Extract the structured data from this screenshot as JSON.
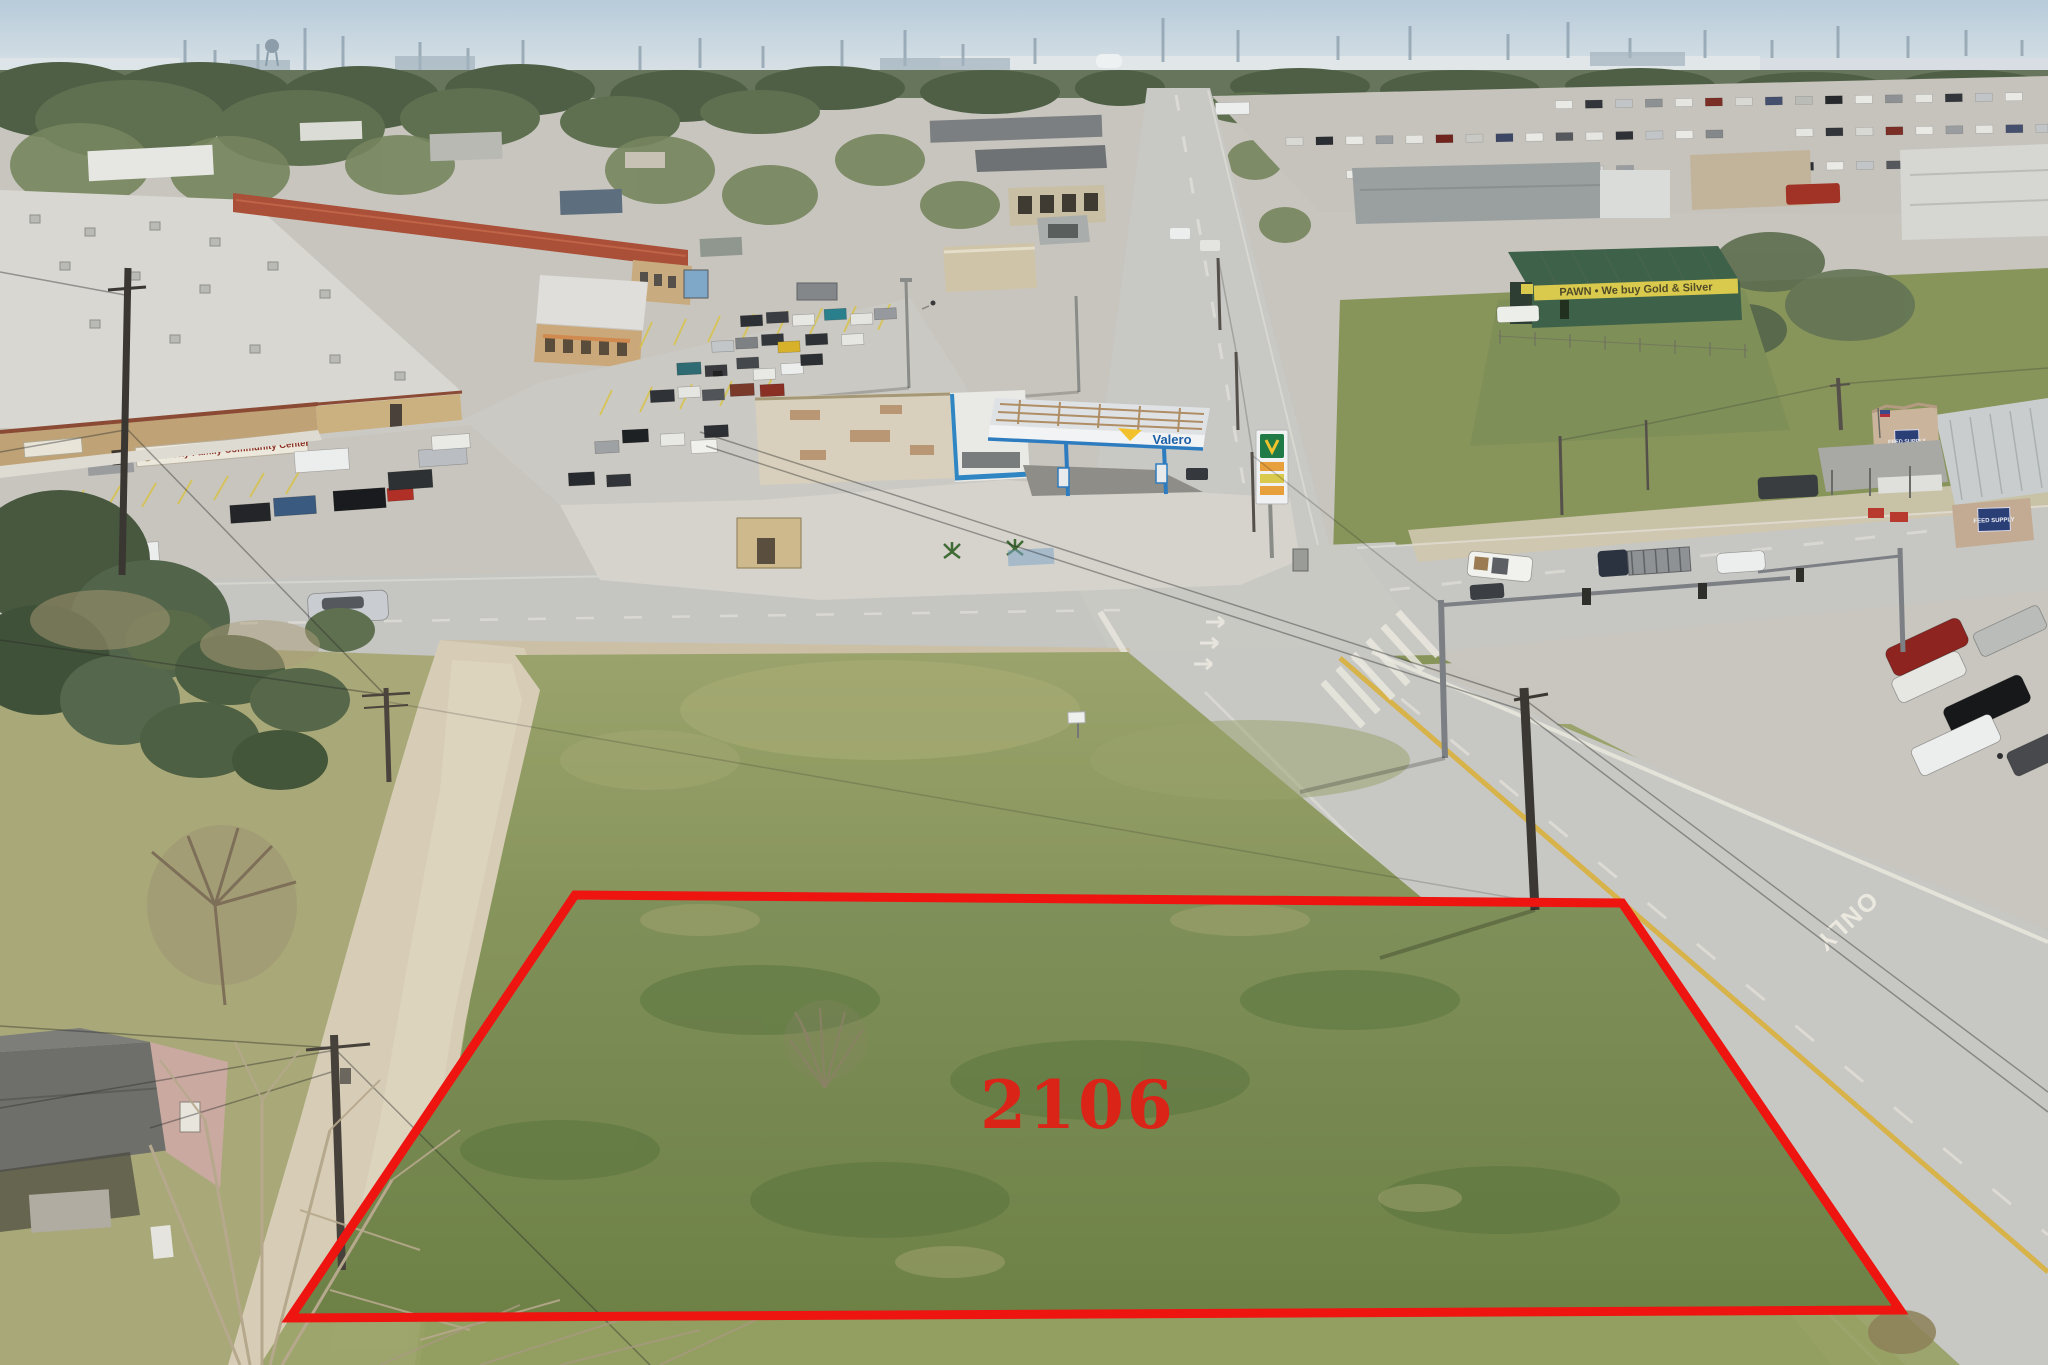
{
  "photo": {
    "kind": "aerial-drone-photo",
    "subject": "vacant corner lot outlined in red at a commercial intersection",
    "lot_number": "2106"
  },
  "labels": {
    "lot_number": "2106",
    "community_center_sign": "Texas City Family Community Center",
    "valero_brand": "Valero",
    "pawn_shop_banner": "PAWN • We buy Gold & Silver",
    "feed_store_sign": "FEED SUPPLY",
    "road_marking_only": "ONLY"
  },
  "colors": {
    "boundary_red": "#ee1410",
    "lot_number_red": "#da2418",
    "valero_blue": "#1a5fa8",
    "valero_yellow": "#f2c22e",
    "pawn_banner_yellow": "#d9c94d",
    "pawn_building_green": "#3e6149",
    "sky_blue": "#bfd2de"
  }
}
